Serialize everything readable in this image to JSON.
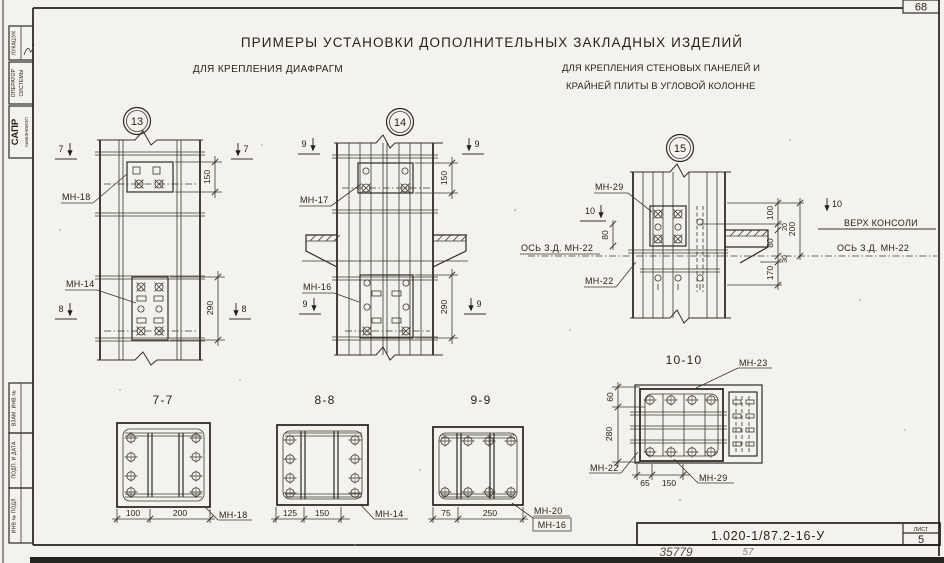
{
  "page": {
    "corner_number": "68",
    "title": "ПРИМЕРЫ УСТАНОВКИ ДОПОЛНИТЕЛЬНЫХ ЗАКЛАДНЫХ ИЗДЕЛИЙ",
    "subtitle_left": "ДЛЯ КРЕПЛЕНИЯ ДИАФРАГМ",
    "subtitle_right1": "ДЛЯ КРЕПЛЕНИЯ СТЕНОВЫХ ПАНЕЛЕЙ И",
    "subtitle_right2": "КРАЙНЕЙ ПЛИТЫ В УГЛОВОЙ КОЛОННЕ"
  },
  "stamps": {
    "author": "ЛУКАШУК",
    "role1": "ОПЕРАТОР",
    "role2": "СИСТЕМЫ",
    "org_big": "САПР",
    "org_small": "КиевЗНИИЭП",
    "vzam": "ВЗАМ. ИНВ.№",
    "podp": "ПОДП. И ДАТА",
    "inv": "ИНВ.№ ПОДЛ."
  },
  "fig13": {
    "num": "13",
    "mn_top": "МН-18",
    "mn_bot": "МН-14",
    "dim_top": "150",
    "dim_bot": "290",
    "sec_top": "7",
    "sec_bot": "8"
  },
  "fig14": {
    "num": "14",
    "mn_top": "МН-17",
    "mn_bot": "МН-16",
    "dim_top": "150",
    "dim_bot": "290",
    "sec": "9"
  },
  "fig15": {
    "num": "15",
    "mn29": "МН-29",
    "mn22": "МН-22",
    "sec": "10",
    "axis_left": "ОСЬ З.Д. МН-22",
    "axis_right": "ОСЬ З.Д. МН-22",
    "verh": "ВЕРХ КОНСОЛИ",
    "d80l": "80",
    "d100": "100",
    "d20": "20",
    "d200": "200",
    "d80": "80",
    "d30": "30",
    "d170": "170"
  },
  "sec77": {
    "title": "7-7",
    "d1": "100",
    "d2": "200",
    "mn": "МН-18"
  },
  "sec88": {
    "title": "8-8",
    "d1": "125",
    "d2": "150",
    "mn": "МН-14"
  },
  "sec99": {
    "title": "9-9",
    "d1": "75",
    "d2": "250",
    "mn1": "МН-20",
    "mn2": "МН-16"
  },
  "sec1010": {
    "title": "10-10",
    "dl1": "60",
    "dl2": "280",
    "d1": "65",
    "d2": "150",
    "mn_top": "МН-23",
    "mn_left": "МН-22",
    "mn_bot": "МН-29"
  },
  "title_block": {
    "doc": "1.020-1/87.2-16-У",
    "sheet_label": "ЛИСТ",
    "sheet": "5",
    "hand1": "35779",
    "hand2": "57"
  }
}
